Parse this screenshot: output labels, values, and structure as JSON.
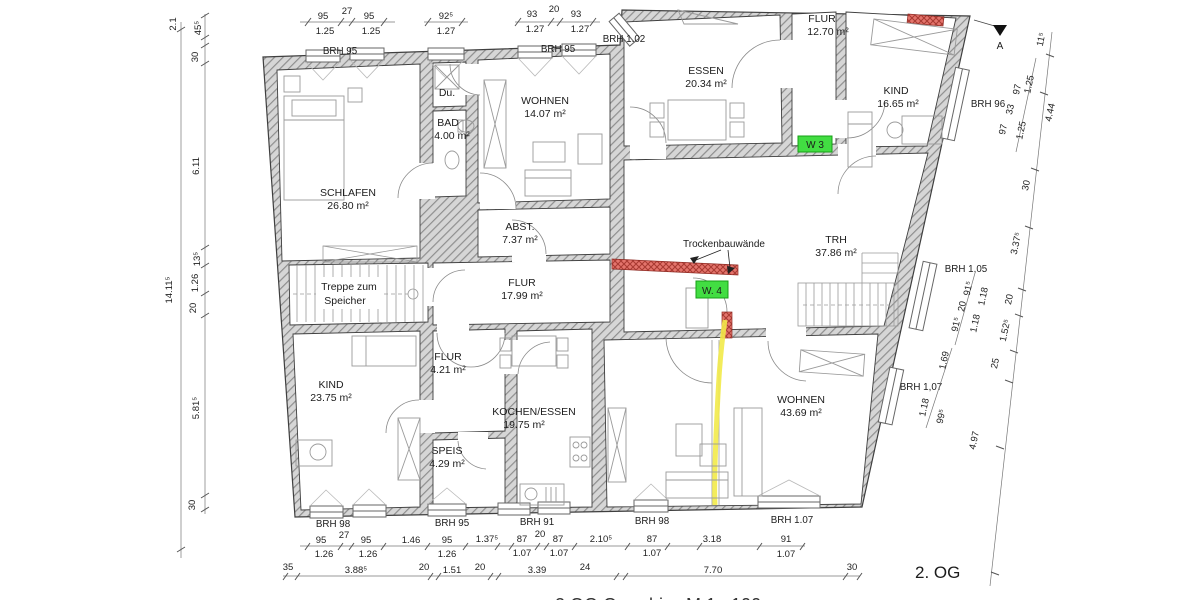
{
  "title": "2. OG",
  "footer": "2.OG Grundriss   M 1 : 100",
  "rooms": {
    "schlafen": {
      "name": "SCHLAFEN",
      "area": "26.80 m²"
    },
    "du": {
      "name": "Du."
    },
    "bad": {
      "name": "BAD",
      "area": "4.00 m²"
    },
    "wohnen1": {
      "name": "WOHNEN",
      "area": "14.07 m²"
    },
    "essen": {
      "name": "ESSEN",
      "area": "20.34 m²"
    },
    "flur1": {
      "name": "FLUR",
      "area": "12.70 m²"
    },
    "kind1": {
      "name": "KIND",
      "area": "16.65 m²"
    },
    "abst": {
      "name": "ABST.",
      "area": "7.37 m²"
    },
    "flur2": {
      "name": "FLUR",
      "area": "17.99 m²"
    },
    "trh": {
      "name": "TRH",
      "area": "37.86 m²"
    },
    "treppe": {
      "line1": "Treppe zum",
      "line2": "Speicher"
    },
    "kind2": {
      "name": "KIND",
      "area": "23.75 m²"
    },
    "flur3": {
      "name": "FLUR",
      "area": "4.21 m²"
    },
    "speis": {
      "name": "SPEIS",
      "area": "4.29 m²"
    },
    "kochen": {
      "name": "KOCHEN/ESSEN",
      "area": "19.75 m²"
    },
    "wohnen2": {
      "name": "WOHNEN",
      "area": "43.69 m²"
    }
  },
  "annotations": {
    "trockenbau": "Trockenbauwände",
    "w3": "W 3",
    "w4": "W. 4",
    "section": "A"
  },
  "brh": {
    "t1": "BRH 95",
    "t2": "BRH 95",
    "t3": "BRH 1.02",
    "r1": "BRH 96",
    "r2": "BRH 1,05",
    "r3": "BRH 1,07",
    "b1": "BRH 98",
    "b2": "BRH 95",
    "b3": "BRH 91",
    "b4": "BRH 98",
    "b5": "BRH 1.07"
  },
  "dims": {
    "top": [
      "95",
      "27",
      "95",
      "1.25",
      "1.25",
      "92⁵",
      "1.27",
      "93",
      "20",
      "93",
      "1.27",
      "1.27"
    ],
    "left": [
      "2.1",
      "45⁵",
      "30",
      "6.11",
      "13⁵",
      "1.26",
      "20",
      "5.81⁵",
      "30",
      "14.11⁵"
    ],
    "right": [
      "11⁵",
      "97",
      "33",
      "97",
      "1.25",
      "1.25",
      "4.44",
      "30",
      "3.37⁵",
      "91⁵",
      "20",
      "91⁵",
      "1.18",
      "1.18",
      "20",
      "1.52⁵",
      "25",
      "1.69",
      "1.18",
      "99⁵",
      "4.97"
    ],
    "bottom1": [
      "95",
      "27",
      "95",
      "1.46",
      "95",
      "1.37⁵",
      "87",
      "20",
      "87",
      "2.10⁵",
      "87",
      "3.18",
      "91"
    ],
    "bottom2": [
      "1.26",
      "1.26",
      "1.26",
      "1.07",
      "1.07",
      "1.07",
      "1.07"
    ],
    "bottom3": [
      "35",
      "3.88⁵",
      "20",
      "1.51",
      "20",
      "3.39",
      "24",
      "7.70",
      "30"
    ]
  },
  "colors": {
    "wall_hatch": "#8e8e8e",
    "wall_bg": "#d6d6d6",
    "new_wall_red": "#e4746c",
    "demolition_yellow": "#f2ea49",
    "marker_green": "#42dd42"
  }
}
